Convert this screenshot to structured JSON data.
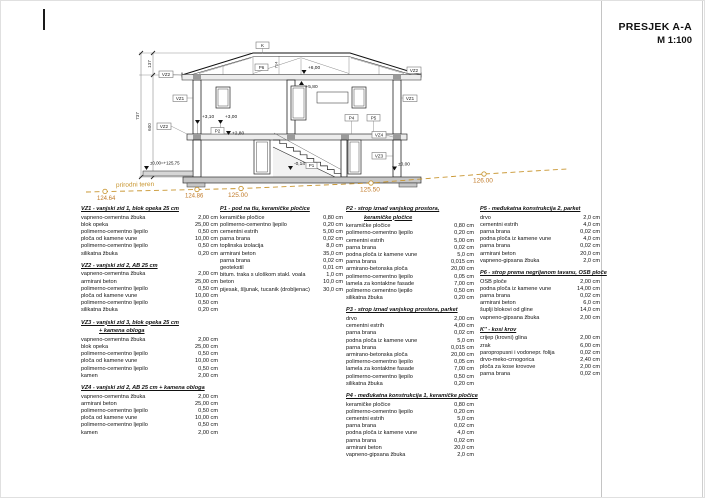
{
  "title": {
    "name": "PRESJEK A-A",
    "scale": "M 1:100"
  },
  "terrain": {
    "label": "prirodni teren",
    "points": [
      "124.64",
      "124.86",
      "125.00",
      "125.50",
      "126.00"
    ]
  },
  "drawing": {
    "tags": {
      "k": "K",
      "p6": "P6",
      "vz1": "VZ1",
      "vz2": "VZ2",
      "vz3": "VZ3",
      "vz4": "VZ4",
      "p1": "P1",
      "p2": "P2",
      "p4": "P4",
      "p5": "P5"
    },
    "levels": {
      "l600": "+6,00",
      "l580": "+5,80",
      "l310": "+3,10",
      "l300": "+3,00",
      "l280": "+2,80",
      "lm014": "-0,14",
      "lzero": "±0,00",
      "lzeroeq": "±0,00=+125,75"
    },
    "dims": {
      "d737": "737",
      "d137": "137",
      "d600": "600",
      "d714": "714"
    }
  },
  "legend": {
    "columns": [
      {
        "x": 80,
        "w": 137,
        "sections": [
          {
            "h": [
              "VZ1 - vanjski zid 1, blok opeka 25 cm"
            ],
            "items": [
              [
                "vapneno-cementna žbuka",
                "2,00 cm"
              ],
              [
                "blok opeka",
                "25,00 cm"
              ],
              [
                "polimerno-cementno ljepilo",
                "0,50 cm"
              ],
              [
                "ploča od kamene vune",
                "10,00 cm"
              ],
              [
                "polimerno-cementno ljepilo",
                "0,50 cm"
              ],
              [
                "silikatna žbuka",
                "0,20 cm"
              ]
            ]
          },
          {
            "h": [
              "VZ2 - vanjski zid 2, AB 25 cm"
            ],
            "items": [
              [
                "vapneno-cementna žbuka",
                "2,00 cm"
              ],
              [
                "armirani beton",
                "25,00 cm"
              ],
              [
                "polimerno-cementno ljepilo",
                "0,50 cm"
              ],
              [
                "ploča od kamene vune",
                "10,00 cm"
              ],
              [
                "polimerno-cementno ljepilo",
                "0,50 cm"
              ],
              [
                "silikatna žbuka",
                "0,20 cm"
              ]
            ]
          },
          {
            "h": [
              "VZ3 - vanjski zid 3, blok opeka 25 cm",
              "+ kamena obloga"
            ],
            "items": [
              [
                "vapneno-cementna žbuka",
                "2,00 cm"
              ],
              [
                "blok opeka",
                "25,00 cm"
              ],
              [
                "polimerno-cementno ljepilo",
                "0,50 cm"
              ],
              [
                "ploča od kamene vune",
                "10,00 cm"
              ],
              [
                "polimerno-cementno ljepilo",
                "0,50 cm"
              ],
              [
                "kamen",
                "2,00 cm"
              ]
            ]
          },
          {
            "h": [
              "VZ4 - vanjski zid 2, AB 25 cm + kamena obloga"
            ],
            "items": [
              [
                "vapneno-cementna žbuka",
                "2,00 cm"
              ],
              [
                "armirani beton",
                "25,00 cm"
              ],
              [
                "polimerno-cementno ljepilo",
                "0,50 cm"
              ],
              [
                "ploča od kamene vune",
                "10,00 cm"
              ],
              [
                "polimerno-cementno ljepilo",
                "0,50 cm"
              ],
              [
                "kamen",
                "2,00 cm"
              ]
            ]
          }
        ]
      },
      {
        "x": 219,
        "w": 123,
        "sections": [
          {
            "h": [
              "P1 - pod na tlu, keramičke pločice"
            ],
            "items": [
              [
                "keramičke pločice",
                "0,80 cm"
              ],
              [
                "polimerno-cementno ljepilo",
                "0,20 cm"
              ],
              [
                "cementni estrih",
                "5,00 cm"
              ],
              [
                "parna brana",
                "0,02 cm"
              ],
              [
                "toplinska izolacija",
                "8,0 cm"
              ],
              [
                "armirani beton",
                "35,0 cm"
              ],
              [
                "parna brana",
                "0,02 cm"
              ],
              [
                "geotekstil",
                "0,01 cm"
              ],
              [
                "bitum. traka s uloškom stakl. voala",
                "1,0 cm"
              ],
              [
                "beton",
                "10,0 cm"
              ],
              [
                "pijesak, šljunak, tucanik (drobljenac)",
                "30,0 cm"
              ]
            ]
          }
        ]
      },
      {
        "x": 345,
        "w": 128,
        "sections": [
          {
            "h": [
              "P2 - strop iznad vanjskog prostora,",
              "keramičke pločice"
            ],
            "items": [
              [
                "keramičke pločice",
                "0,80 cm"
              ],
              [
                "polimerno-cementno ljepilo",
                "0,20 cm"
              ],
              [
                "cementni estrih",
                "5,00 cm"
              ],
              [
                "parna brana",
                "0,02 cm"
              ],
              [
                "podna ploča iz kamene vune",
                "5,0 cm"
              ],
              [
                "parna brana",
                "0,015 cm"
              ],
              [
                "armirano-betonska ploča",
                "20,00 cm"
              ],
              [
                "polimerno-cementno ljepilo",
                "0,05 cm"
              ],
              [
                "lamela za kontaktne fasade",
                "7,00 cm"
              ],
              [
                "polimerno cementno ljepilo",
                "0,50 cm"
              ],
              [
                "silikatna žbuka",
                "0,20 cm"
              ]
            ]
          },
          {
            "h": [
              "P3 - strop iznad vanjskog prostora,  parket"
            ],
            "items": [
              [
                "drvo",
                "2,00 cm"
              ],
              [
                "cementni estrih",
                "4,00 cm"
              ],
              [
                "parna brana",
                "0,02 cm"
              ],
              [
                "podna ploča iz kamene vune",
                "5,0 cm"
              ],
              [
                "parna brana",
                "0,015 cm"
              ],
              [
                "armirano-betonska ploča",
                "20,00 cm"
              ],
              [
                "polimerno-cementno ljepilo",
                "0,05 cm"
              ],
              [
                "lamela za kontaktne fasade",
                "7,00 cm"
              ],
              [
                "polimerno-cementno ljepilo",
                "0,50 cm"
              ],
              [
                "silikatna žbuka",
                "0,20 cm"
              ]
            ]
          },
          {
            "h": [
              "P4 - međukatna konstrukcija 1, keramičke pločice"
            ],
            "items": [
              [
                "keramičke pločice",
                "0,80 cm"
              ],
              [
                "polimerno-cementno ljepilo",
                "0,20 cm"
              ],
              [
                "cementni estrih",
                "5,0 cm"
              ],
              [
                "parna brana",
                "0,02 cm"
              ],
              [
                "podna ploča iz kamene vune",
                "4,0 cm"
              ],
              [
                "parna brana",
                "0,02 cm"
              ],
              [
                "armirani beton",
                "20,0 cm"
              ],
              [
                "vapneno-gipsana žbuka",
                "2,0 cm"
              ]
            ]
          }
        ]
      },
      {
        "x": 479,
        "w": 120,
        "sections": [
          {
            "h": [
              "P5 -  međukatna konstrukcija 2, parket"
            ],
            "items": [
              [
                "drvo",
                "2,0 cm"
              ],
              [
                "cementni estrih",
                "4,0 cm"
              ],
              [
                "parna brana",
                "0,02 cm"
              ],
              [
                "podna ploča iz kamene vune",
                "4,0 cm"
              ],
              [
                "parna brana",
                "0,02 cm"
              ],
              [
                "armirani beton",
                "20,0 cm"
              ],
              [
                "vapneno-gipsana žbuka",
                "2,0 cm"
              ]
            ]
          },
          {
            "h": [
              "P6 - strop prema negrijanom tavanu, OSB ploče"
            ],
            "items": [
              [
                "OSB ploče",
                "2,00 cm"
              ],
              [
                "podna ploča iz kamene vune",
                "14,00 cm"
              ],
              [
                "parna brana",
                "0,02 cm"
              ],
              [
                "armirani beton",
                "6,0 cm"
              ],
              [
                "šuplji blokovi od gline",
                "14,0 cm"
              ],
              [
                "vapneno-gipsana žbuka",
                "2,00 cm"
              ]
            ]
          },
          {
            "h": [
              "K'' - kosi krov"
            ],
            "items": [
              [
                "crijep (krovni) glina",
                "2,00 cm"
              ],
              [
                "zrak",
                "6,00 cm"
              ],
              [
                "paropropusni i vodonepr. folija",
                "0,02 cm"
              ],
              [
                "drvo-meko-crnogorica",
                "2,40 cm"
              ],
              [
                "ploča za kose krovove",
                "2,00 cm"
              ],
              [
                "parna brana",
                "0,02 cm"
              ]
            ]
          }
        ]
      }
    ]
  }
}
